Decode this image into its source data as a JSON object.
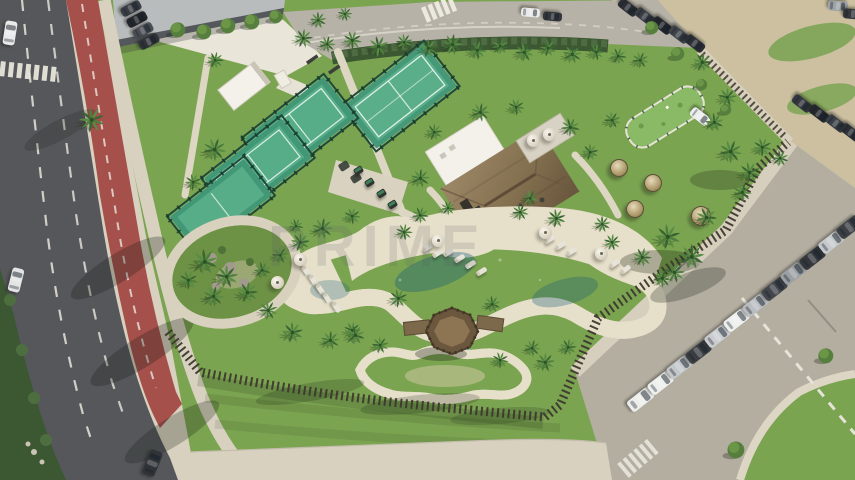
{
  "watermark": {
    "text": "PRIME"
  },
  "palette": {
    "grass": "#7ba451",
    "grassdark": "#5f8a3e",
    "concrete": "#d8d1c0",
    "sand": "#ccc0a1",
    "parking": "#b4aea1",
    "asphalt": "#55575b",
    "bikelane": "#a6504b",
    "hedge": "#3c5833",
    "court": "#2e8b68",
    "courtlight": "#47a57c",
    "deck": "#e6dfca",
    "pooldeep": "#1f7fa0",
    "poollight": "#67c2cf",
    "kidspool": "#a9d8de",
    "thatch": "#8a7354",
    "fencewood": "#3e382e",
    "roofwhite": "#f3f1ea"
  },
  "scene": {
    "palms": [
      [
        303,
        38,
        9
      ],
      [
        327,
        44,
        8
      ],
      [
        352,
        40,
        9
      ],
      [
        378,
        46,
        10
      ],
      [
        404,
        42,
        8
      ],
      [
        428,
        48,
        9
      ],
      [
        452,
        44,
        10
      ],
      [
        477,
        50,
        9
      ],
      [
        500,
        46,
        8
      ],
      [
        524,
        52,
        9
      ],
      [
        548,
        48,
        8
      ],
      [
        572,
        54,
        9
      ],
      [
        596,
        52,
        8
      ],
      [
        618,
        56,
        8
      ],
      [
        640,
        60,
        8
      ],
      [
        92,
        120,
        12
      ],
      [
        318,
        20,
        8
      ],
      [
        345,
        14,
        7
      ],
      [
        215,
        60,
        8
      ],
      [
        215,
        150,
        11
      ],
      [
        193,
        182,
        8
      ],
      [
        205,
        262,
        12
      ],
      [
        227,
        277,
        11
      ],
      [
        247,
        292,
        10
      ],
      [
        213,
        296,
        10
      ],
      [
        188,
        280,
        9
      ],
      [
        262,
        270,
        8
      ],
      [
        280,
        255,
        8
      ],
      [
        300,
        242,
        9
      ],
      [
        322,
        228,
        10
      ],
      [
        352,
        216,
        8
      ],
      [
        296,
        226,
        7
      ],
      [
        268,
        310,
        9
      ],
      [
        292,
        332,
        10
      ],
      [
        330,
        340,
        9
      ],
      [
        352,
        330,
        8
      ],
      [
        420,
        215,
        8
      ],
      [
        520,
        212,
        8
      ],
      [
        556,
        218,
        9
      ],
      [
        602,
        224,
        8
      ],
      [
        612,
        242,
        8
      ],
      [
        642,
        257,
        9
      ],
      [
        662,
        278,
        9
      ],
      [
        398,
        298,
        9
      ],
      [
        492,
        304,
        8
      ],
      [
        545,
        362,
        9
      ],
      [
        568,
        347,
        8
      ],
      [
        532,
        348,
        8
      ],
      [
        500,
        360,
        8
      ],
      [
        355,
        335,
        9
      ],
      [
        380,
        345,
        8
      ],
      [
        434,
        132,
        8
      ],
      [
        480,
        112,
        9
      ],
      [
        516,
        107,
        8
      ],
      [
        570,
        127,
        9
      ],
      [
        612,
        120,
        8
      ],
      [
        590,
        152,
        8
      ],
      [
        420,
        178,
        9
      ],
      [
        404,
        232,
        8
      ],
      [
        448,
        208,
        7
      ],
      [
        530,
        198,
        8
      ],
      [
        668,
        237,
        12
      ],
      [
        692,
        257,
        12
      ],
      [
        674,
        272,
        10
      ],
      [
        706,
        217,
        10
      ],
      [
        731,
        152,
        11
      ],
      [
        749,
        172,
        10
      ],
      [
        714,
        122,
        9
      ],
      [
        727,
        97,
        9
      ],
      [
        702,
        62,
        9
      ],
      [
        742,
        192,
        9
      ],
      [
        762,
        147,
        9
      ],
      [
        780,
        158,
        8
      ]
    ],
    "trees": [
      [
        178,
        30,
        8
      ],
      [
        204,
        32,
        8
      ],
      [
        228,
        26,
        8
      ],
      [
        252,
        22,
        8
      ],
      [
        276,
        17,
        7
      ],
      [
        652,
        28,
        7
      ],
      [
        678,
        54,
        7
      ],
      [
        702,
        85,
        6
      ],
      [
        726,
        110,
        6
      ],
      [
        736,
        450,
        9
      ],
      [
        826,
        356,
        8
      ]
    ],
    "cars": [
      {
        "x": 10,
        "y": 33,
        "r": 9,
        "c": "#e9ebea",
        "w": 12,
        "h": 24
      },
      {
        "x": 16,
        "y": 280,
        "r": 14,
        "c": "#e2e5e4",
        "w": 12,
        "h": 24
      },
      {
        "x": 152,
        "y": 463,
        "r": 22,
        "c": "#303438",
        "w": 13,
        "h": 26
      },
      {
        "x": 131,
        "y": 8,
        "r": 62,
        "c": "#3a3e44",
        "w": 10,
        "h": 21
      },
      {
        "x": 137,
        "y": 19,
        "r": 62,
        "c": "#23262b",
        "w": 10,
        "h": 21
      },
      {
        "x": 143,
        "y": 30,
        "r": 62,
        "c": "#4a4e54",
        "w": 10,
        "h": 21
      },
      {
        "x": 149,
        "y": 41,
        "r": 62,
        "c": "#2f3338",
        "w": 10,
        "h": 21
      },
      {
        "x": 530,
        "y": 12,
        "r": 95,
        "c": "#e9ebea",
        "w": 9,
        "h": 19
      },
      {
        "x": 552,
        "y": 16,
        "r": 95,
        "c": "#33373c",
        "w": 9,
        "h": 19
      },
      {
        "x": 628,
        "y": 7,
        "r": 128,
        "c": "#2b2f35",
        "w": 10,
        "h": 21
      },
      {
        "x": 645,
        "y": 16,
        "r": 128,
        "c": "#383d44",
        "w": 10,
        "h": 21
      },
      {
        "x": 662,
        "y": 25,
        "r": 128,
        "c": "#22262b",
        "w": 10,
        "h": 21
      },
      {
        "x": 679,
        "y": 34,
        "r": 128,
        "c": "#3f444b",
        "w": 10,
        "h": 21
      },
      {
        "x": 695,
        "y": 43,
        "r": 128,
        "c": "#2b2f35",
        "w": 10,
        "h": 21
      },
      {
        "x": 802,
        "y": 103,
        "r": 128,
        "c": "#34383e",
        "w": 10,
        "h": 21
      },
      {
        "x": 819,
        "y": 113,
        "r": 128,
        "c": "#24282d",
        "w": 10,
        "h": 21
      },
      {
        "x": 836,
        "y": 123,
        "r": 128,
        "c": "#3b4046",
        "w": 10,
        "h": 21
      },
      {
        "x": 851,
        "y": 132,
        "r": 128,
        "c": "#2c3036",
        "w": 10,
        "h": 21
      },
      {
        "x": 838,
        "y": 6,
        "r": 95,
        "c": "#9fa4a8",
        "w": 10,
        "h": 20
      },
      {
        "x": 853,
        "y": 14,
        "r": 95,
        "c": "#34383d",
        "w": 10,
        "h": 20
      },
      {
        "x": 700,
        "y": 116,
        "r": 128,
        "c": "#eceeee",
        "w": 10,
        "h": 21
      },
      {
        "x": 640,
        "y": 399,
        "r": 52,
        "c": "#edeeec",
        "w": 13,
        "h": 27
      },
      {
        "x": 660,
        "y": 383,
        "r": 52,
        "c": "#eef0ee",
        "w": 13,
        "h": 26
      },
      {
        "x": 679,
        "y": 367,
        "r": 52,
        "c": "#c3c7ca",
        "w": 13,
        "h": 26
      },
      {
        "x": 698,
        "y": 352,
        "r": 52,
        "c": "#3a3e43",
        "w": 13,
        "h": 26
      },
      {
        "x": 717,
        "y": 336,
        "r": 52,
        "c": "#c9cdd0",
        "w": 13,
        "h": 26
      },
      {
        "x": 736,
        "y": 320,
        "r": 52,
        "c": "#eef0ef",
        "w": 13,
        "h": 26
      },
      {
        "x": 755,
        "y": 305,
        "r": 52,
        "c": "#b9bdc1",
        "w": 13,
        "h": 26
      },
      {
        "x": 774,
        "y": 289,
        "r": 52,
        "c": "#43474c",
        "w": 13,
        "h": 26
      },
      {
        "x": 793,
        "y": 273,
        "r": 52,
        "c": "#9ba0a4",
        "w": 13,
        "h": 26
      },
      {
        "x": 812,
        "y": 258,
        "r": 52,
        "c": "#34383d",
        "w": 13,
        "h": 26
      },
      {
        "x": 831,
        "y": 242,
        "r": 52,
        "c": "#c6cacd",
        "w": 13,
        "h": 26
      },
      {
        "x": 849,
        "y": 227,
        "r": 52,
        "c": "#3c4045",
        "w": 13,
        "h": 26
      }
    ],
    "loungers": [
      [
        448,
        252,
        -32
      ],
      [
        459,
        258,
        -32
      ],
      [
        470,
        264,
        -32
      ],
      [
        481,
        271,
        -32
      ],
      [
        427,
        247,
        -32
      ],
      [
        437,
        253,
        -32
      ],
      [
        549,
        239,
        -32
      ],
      [
        560,
        245,
        -32
      ],
      [
        571,
        251,
        -32
      ],
      [
        614,
        263,
        -36
      ],
      [
        625,
        269,
        -36
      ],
      [
        306,
        271,
        56
      ],
      [
        313,
        280,
        56
      ],
      [
        320,
        289,
        56
      ],
      [
        327,
        298,
        56
      ],
      [
        336,
        307,
        56
      ]
    ],
    "umbrellas": [
      [
        300,
        259
      ],
      [
        277,
        282
      ],
      [
        438,
        240
      ],
      [
        545,
        232
      ],
      [
        601,
        253
      ],
      [
        533,
        140
      ],
      [
        549,
        134
      ]
    ],
    "cabanas": [
      [
        618,
        167,
        8
      ],
      [
        652,
        182,
        8
      ],
      [
        634,
        208,
        8
      ],
      [
        700,
        215,
        9
      ]
    ],
    "gym": [
      [
        358,
        170
      ],
      [
        369,
        182
      ],
      [
        381,
        193
      ],
      [
        392,
        204
      ]
    ],
    "mats": [
      [
        344,
        166
      ],
      [
        356,
        178
      ]
    ]
  }
}
